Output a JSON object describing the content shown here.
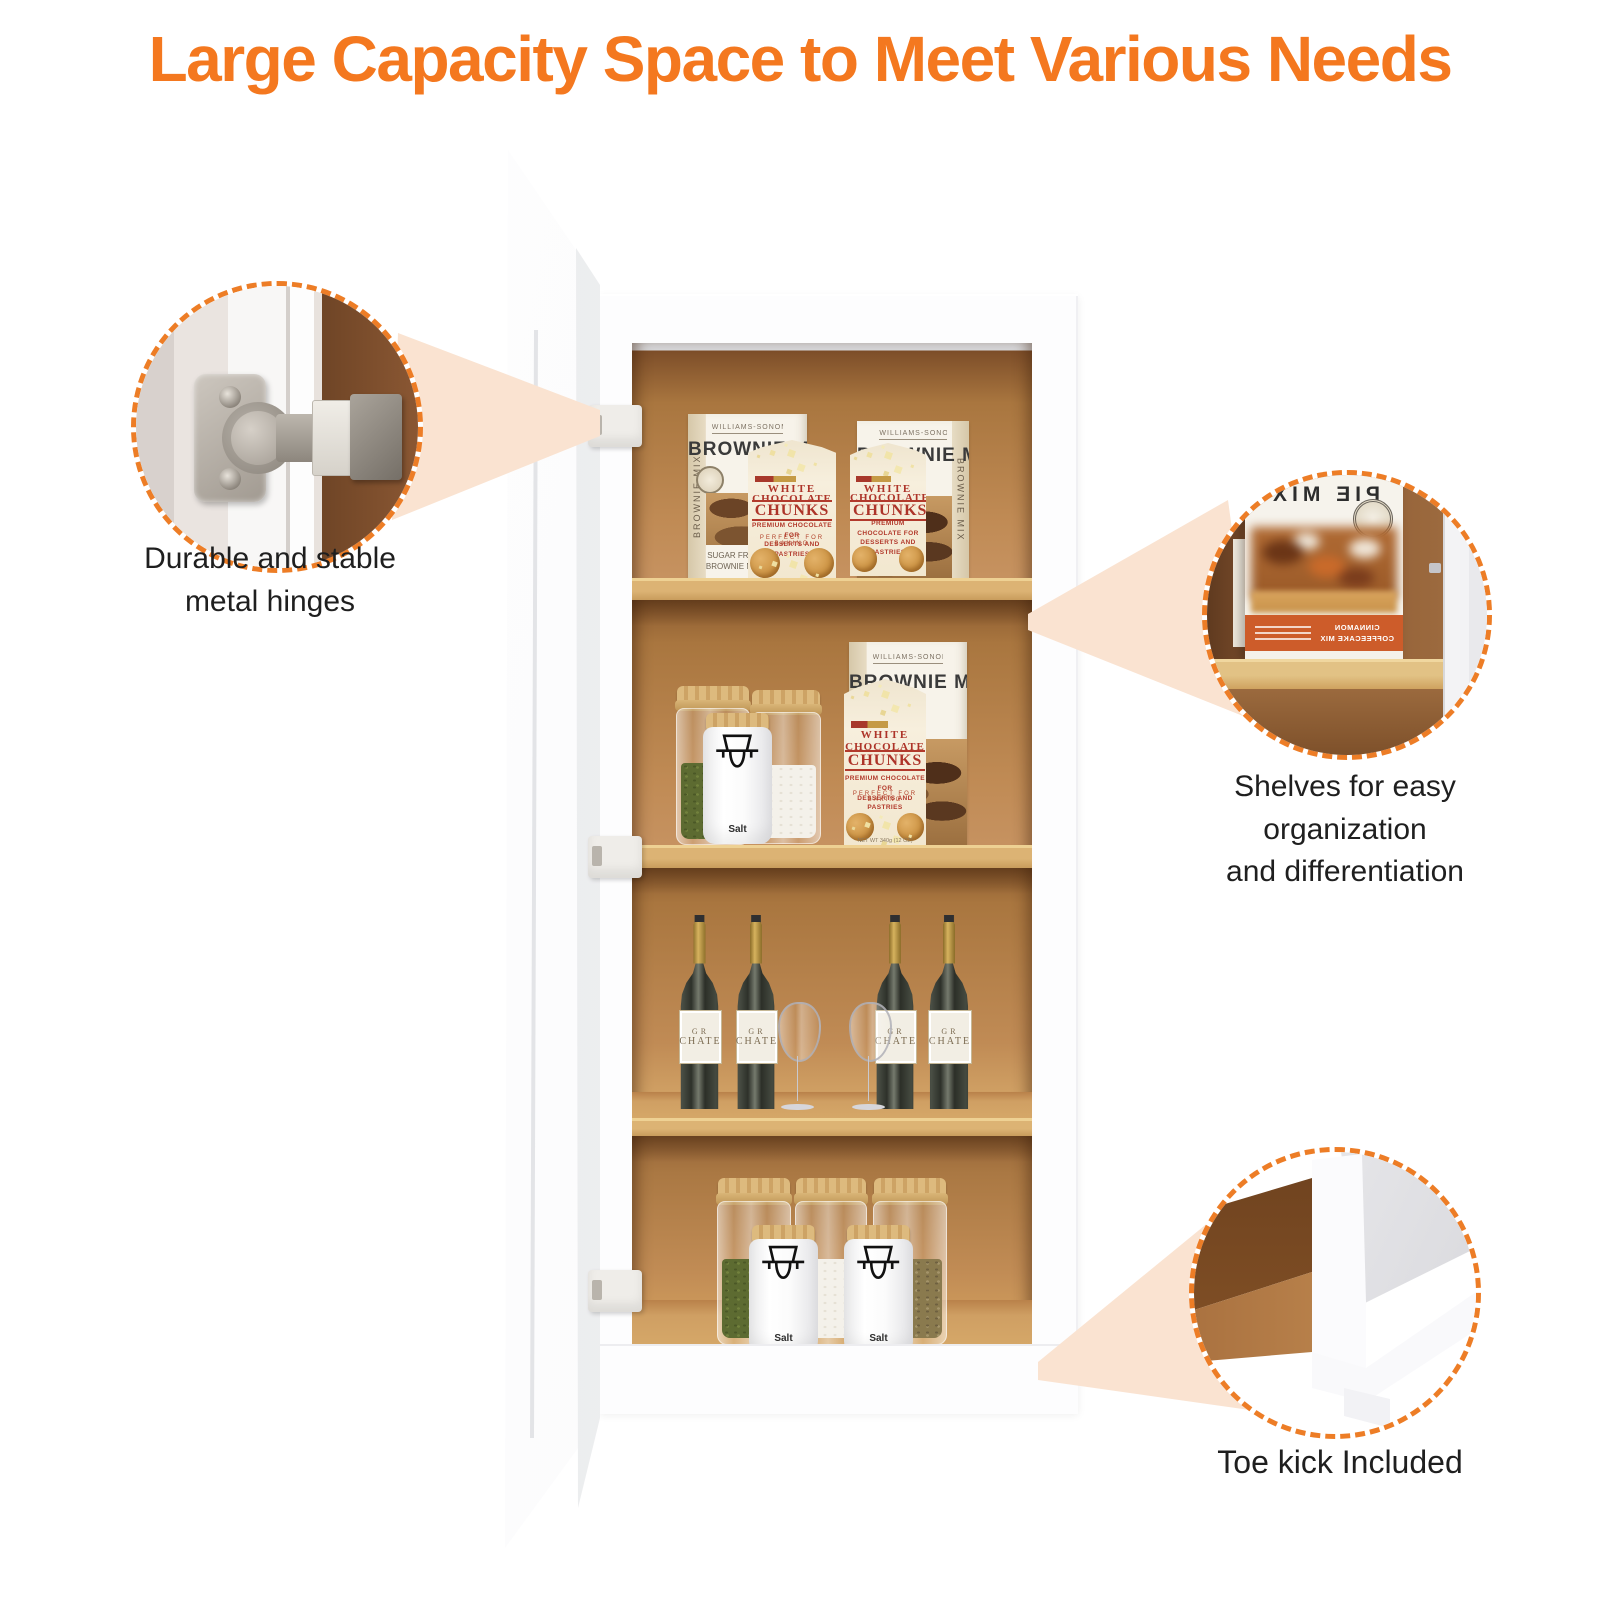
{
  "title": "Large Capacity Space to Meet Various Needs",
  "colors": {
    "accent": "#F4781F",
    "callout_dash": "#ED7D26",
    "beam": "#FAE3D1",
    "interior_wood": "#C08B55",
    "shelf_wood": "#DCB374"
  },
  "callouts": {
    "hinge": {
      "lines": [
        "Durable and stable",
        "metal hinges"
      ]
    },
    "shelves": {
      "lines": [
        "Shelves for easy",
        "organization",
        "and differentiation"
      ]
    },
    "toekick": {
      "lines": [
        "Toe kick Included"
      ]
    }
  },
  "products": {
    "brownie_box": {
      "brand": "WILLIAMS-SONOMA",
      "name": "BROWNIE MIX",
      "side_text": "BROWNIE MIX",
      "corner_line1": "SUGAR FREE",
      "corner_line2": "BROWNIE MIX"
    },
    "chunks_bag": {
      "line1": "WHITE",
      "line2": "CHOCOLATE",
      "line3": "CHUNKS",
      "sub1": "PREMIUM CHOCOLATE FOR",
      "sub2": "DESSERTS AND PASTRIES",
      "arc": "PERFECT FOR BAKING",
      "net": "NET WT 340g (12 OZ)"
    },
    "salt_jar": {
      "label": "Salt"
    },
    "wine_bottle": {
      "label_line1": "GR",
      "label_line2": "CHATE"
    },
    "pie_box": {
      "name": "PIE MIX",
      "band_line1": "CINNAMON",
      "band_line2": "COFFEECAKE MIX"
    }
  }
}
